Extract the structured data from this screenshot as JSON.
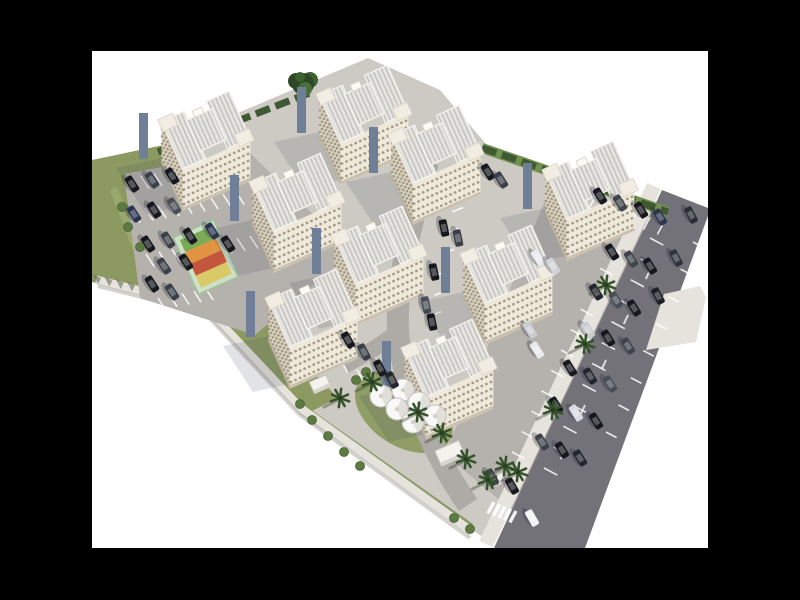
{
  "scene": {
    "type": "architectural-aerial-render",
    "description": "Bird's-eye 3D rendering of a residential condominium: nine white mid-rise apartment towers with ribbed gray roofs arranged on a diagonal grid, internal parking lots full of cars, a lawn with a fenced multicolor playground on the left, white water tanks among greenery at the bottom, palm trees along the perimeter and a dark public road running down the right side. Letterboxed on a black background.",
    "frame": {
      "background": "#000000",
      "canvas": {
        "x": 92,
        "y": 51,
        "width": 616,
        "height": 497,
        "background": "#ffffff"
      }
    },
    "palette": {
      "frame": "#000000",
      "paper": "#ffffff",
      "pavement": "#cdcac4",
      "parking": "#b5b2ad",
      "internal_road": "#aeaba6",
      "public_road": "#747279",
      "sidewalk": "#e6e3dc",
      "lawn": "#8c9a62",
      "lawn_stripe": "#b2bf80",
      "hedge_dark": "#3f5a32",
      "hedge_light": "#72904f",
      "palm": "#35522b",
      "roof_light": "#e8e6e2",
      "roof_rib": "#c6c4c0",
      "facade_lit": "#efe9dc",
      "facade_shade": "#d6cfc0",
      "core": "#f1ede3",
      "window": "#93876f",
      "glass": "#6e7f97",
      "shadow": "#3f4654",
      "stall_line": "#ffffff",
      "tank": "#f8f8f6",
      "playground_fence": "#cfe0c8"
    },
    "buildings": {
      "count": 9,
      "floors": 7,
      "roof_style": "ribbed-metal",
      "positions": [
        [
          364,
          104
        ],
        [
          206,
          130
        ],
        [
          436,
          144
        ],
        [
          590,
          180
        ],
        [
          297,
          192
        ],
        [
          379,
          245
        ],
        [
          508,
          264
        ],
        [
          313,
          308
        ],
        [
          449,
          358
        ]
      ]
    },
    "cars": {
      "count": 58,
      "items": [
        [
          132,
          184,
          57,
          "#16181d"
        ],
        [
          152,
          180,
          57,
          "#3b3f48"
        ],
        [
          172,
          176,
          57,
          "#16181d"
        ],
        [
          134,
          214,
          57,
          "#2c3550"
        ],
        [
          154,
          210,
          57,
          "#16181d"
        ],
        [
          174,
          206,
          57,
          "#4a4e57"
        ],
        [
          148,
          244,
          57,
          "#16181d"
        ],
        [
          168,
          240,
          57,
          "#3b3f48"
        ],
        [
          190,
          236,
          57,
          "#16181d"
        ],
        [
          212,
          231,
          57,
          "#2c3550"
        ],
        [
          228,
          244,
          57,
          "#16181d"
        ],
        [
          164,
          266,
          57,
          "#3b3f48"
        ],
        [
          186,
          262,
          57,
          "#16181d"
        ],
        [
          152,
          284,
          57,
          "#16181d"
        ],
        [
          172,
          292,
          57,
          "#3b3f48"
        ],
        [
          488,
          172,
          58,
          "#16181d"
        ],
        [
          501,
          180,
          58,
          "#3b3f48"
        ],
        [
          444,
          228,
          78,
          "#16181d"
        ],
        [
          458,
          238,
          78,
          "#3b3f48"
        ],
        [
          434,
          272,
          78,
          "#16181d"
        ],
        [
          426,
          305,
          78,
          "#4a4e57"
        ],
        [
          432,
          322,
          78,
          "#16181d"
        ],
        [
          348,
          340,
          60,
          "#16181d"
        ],
        [
          364,
          352,
          62,
          "#3b3f48"
        ],
        [
          380,
          368,
          62,
          "#16181d"
        ],
        [
          392,
          380,
          62,
          "#23262c"
        ],
        [
          492,
          477,
          60,
          "#3b3f48"
        ],
        [
          512,
          486,
          60,
          "#16181d"
        ],
        [
          600,
          196,
          58,
          "#16181d"
        ],
        [
          620,
          203,
          58,
          "#3f434b"
        ],
        [
          641,
          210,
          58,
          "#16181d"
        ],
        [
          660,
          217,
          58,
          "#2c3550"
        ],
        [
          538,
          258,
          58,
          "#e8eaed"
        ],
        [
          553,
          266,
          58,
          "#cfd3d8"
        ],
        [
          612,
          252,
          58,
          "#16181d"
        ],
        [
          631,
          259,
          58,
          "#3f434b"
        ],
        [
          650,
          266,
          58,
          "#16181d"
        ],
        [
          596,
          292,
          58,
          "#23262c"
        ],
        [
          616,
          300,
          58,
          "#4a4e57"
        ],
        [
          634,
          308,
          58,
          "#16181d"
        ],
        [
          588,
          330,
          58,
          "#c9ccd2"
        ],
        [
          608,
          338,
          58,
          "#16181d"
        ],
        [
          628,
          346,
          58,
          "#3f434b"
        ],
        [
          570,
          368,
          58,
          "#16181d"
        ],
        [
          590,
          376,
          58,
          "#23262c"
        ],
        [
          610,
          384,
          58,
          "#4a4e57"
        ],
        [
          556,
          405,
          58,
          "#16181d"
        ],
        [
          576,
          413,
          58,
          "#d8dbe0"
        ],
        [
          596,
          421,
          58,
          "#16181d"
        ],
        [
          542,
          442,
          58,
          "#3f434b"
        ],
        [
          562,
          450,
          58,
          "#16181d"
        ],
        [
          580,
          458,
          58,
          "#23262c"
        ],
        [
          530,
          330,
          58,
          "#c9ccd2"
        ],
        [
          537,
          350,
          58,
          "#e8eaed"
        ],
        [
          691,
          215,
          62,
          "#2a2d33"
        ],
        [
          676,
          258,
          62,
          "#2f333b"
        ],
        [
          658,
          296,
          62,
          "#1c1f26"
        ],
        [
          532,
          518,
          60,
          "#f2f3f5"
        ]
      ]
    },
    "palms": [
      [
        606,
        285
      ],
      [
        585,
        344
      ],
      [
        553,
        410
      ],
      [
        518,
        472
      ],
      [
        505,
        466
      ],
      [
        488,
        480
      ],
      [
        466,
        459
      ],
      [
        442,
        433
      ],
      [
        418,
        412
      ],
      [
        372,
        382
      ],
      [
        340,
        398
      ]
    ],
    "water_tanks": [
      [
        403,
        390
      ],
      [
        381,
        396
      ],
      [
        419,
        403
      ],
      [
        397,
        409
      ],
      [
        435,
        416
      ],
      [
        413,
        422
      ]
    ],
    "bushes": [
      [
        122,
        207
      ],
      [
        128,
        227
      ],
      [
        140,
        247
      ],
      [
        300,
        404
      ],
      [
        312,
        420
      ],
      [
        328,
        436
      ],
      [
        344,
        452
      ],
      [
        360,
        466
      ],
      [
        454,
        518
      ],
      [
        470,
        529
      ],
      [
        356,
        380
      ],
      [
        366,
        372
      ]
    ],
    "trees": [
      [
        303,
        84
      ]
    ],
    "sheds": [
      [
        450,
        453,
        26,
        16
      ],
      [
        320,
        384,
        18,
        12
      ],
      [
        499,
        479,
        12,
        9
      ]
    ],
    "playground": {
      "x": 206,
      "y": 257,
      "angle": -24,
      "fence_width": 44,
      "fence_height": 62,
      "court_width": 34,
      "court_height": 52,
      "stripes": [
        "#7cab58",
        "#e09340",
        "#c4563e",
        "#d9c967"
      ]
    },
    "stall_rows": [
      {
        "x1": 128,
        "y1": 178,
        "x2": 232,
        "y2": 160,
        "n": 9,
        "ta": 57,
        "tl": 15
      },
      {
        "x1": 132,
        "y1": 210,
        "x2": 236,
        "y2": 192,
        "n": 9,
        "ta": 57,
        "tl": 15
      },
      {
        "x1": 146,
        "y1": 254,
        "x2": 250,
        "y2": 236,
        "n": 9,
        "ta": 57,
        "tl": 15
      },
      {
        "x1": 158,
        "y1": 298,
        "x2": 206,
        "y2": 289,
        "n": 5,
        "ta": 57,
        "tl": 13
      },
      {
        "x1": 452,
        "y1": 212,
        "x2": 430,
        "y2": 316,
        "n": 6,
        "ta": -22,
        "tl": 12
      },
      {
        "x1": 342,
        "y1": 362,
        "x2": 402,
        "y2": 392,
        "n": 5,
        "ta": 62,
        "tl": 12
      },
      {
        "x1": 650,
        "y1": 238,
        "x2": 544,
        "y2": 468,
        "n": 12,
        "ta": 28,
        "tl": 15
      },
      {
        "x1": 610,
        "y1": 248,
        "x2": 512,
        "y2": 452,
        "n": 11,
        "ta": 28,
        "tl": 14
      },
      {
        "x1": 566,
        "y1": 190,
        "x2": 664,
        "y2": 222,
        "n": 8,
        "ta": 118,
        "tl": 14
      },
      {
        "x1": 693,
        "y1": 242,
        "x2": 606,
        "y2": 432,
        "n": 8,
        "ta": 28,
        "tl": 12
      }
    ],
    "crosswalk": {
      "x1": 494,
      "y1": 502,
      "x2": 516,
      "y2": 511,
      "n": 5,
      "ta": 118,
      "tl": 13
    },
    "road_dashes": {
      "angle": 115,
      "len": 10,
      "points": [
        [
          650,
          270
        ],
        [
          628,
          315
        ],
        [
          606,
          360
        ],
        [
          585,
          405
        ],
        [
          565,
          450
        ]
      ]
    },
    "mow_stripes": [
      [
        115,
        192,
        148,
        278
      ],
      [
        133,
        184,
        170,
        270
      ],
      [
        151,
        176,
        192,
        262
      ],
      [
        169,
        168,
        214,
        254
      ]
    ],
    "fence": {
      "from": [
        98,
        284
      ],
      "to": [
        200,
        306
      ],
      "teeth": 10
    }
  }
}
